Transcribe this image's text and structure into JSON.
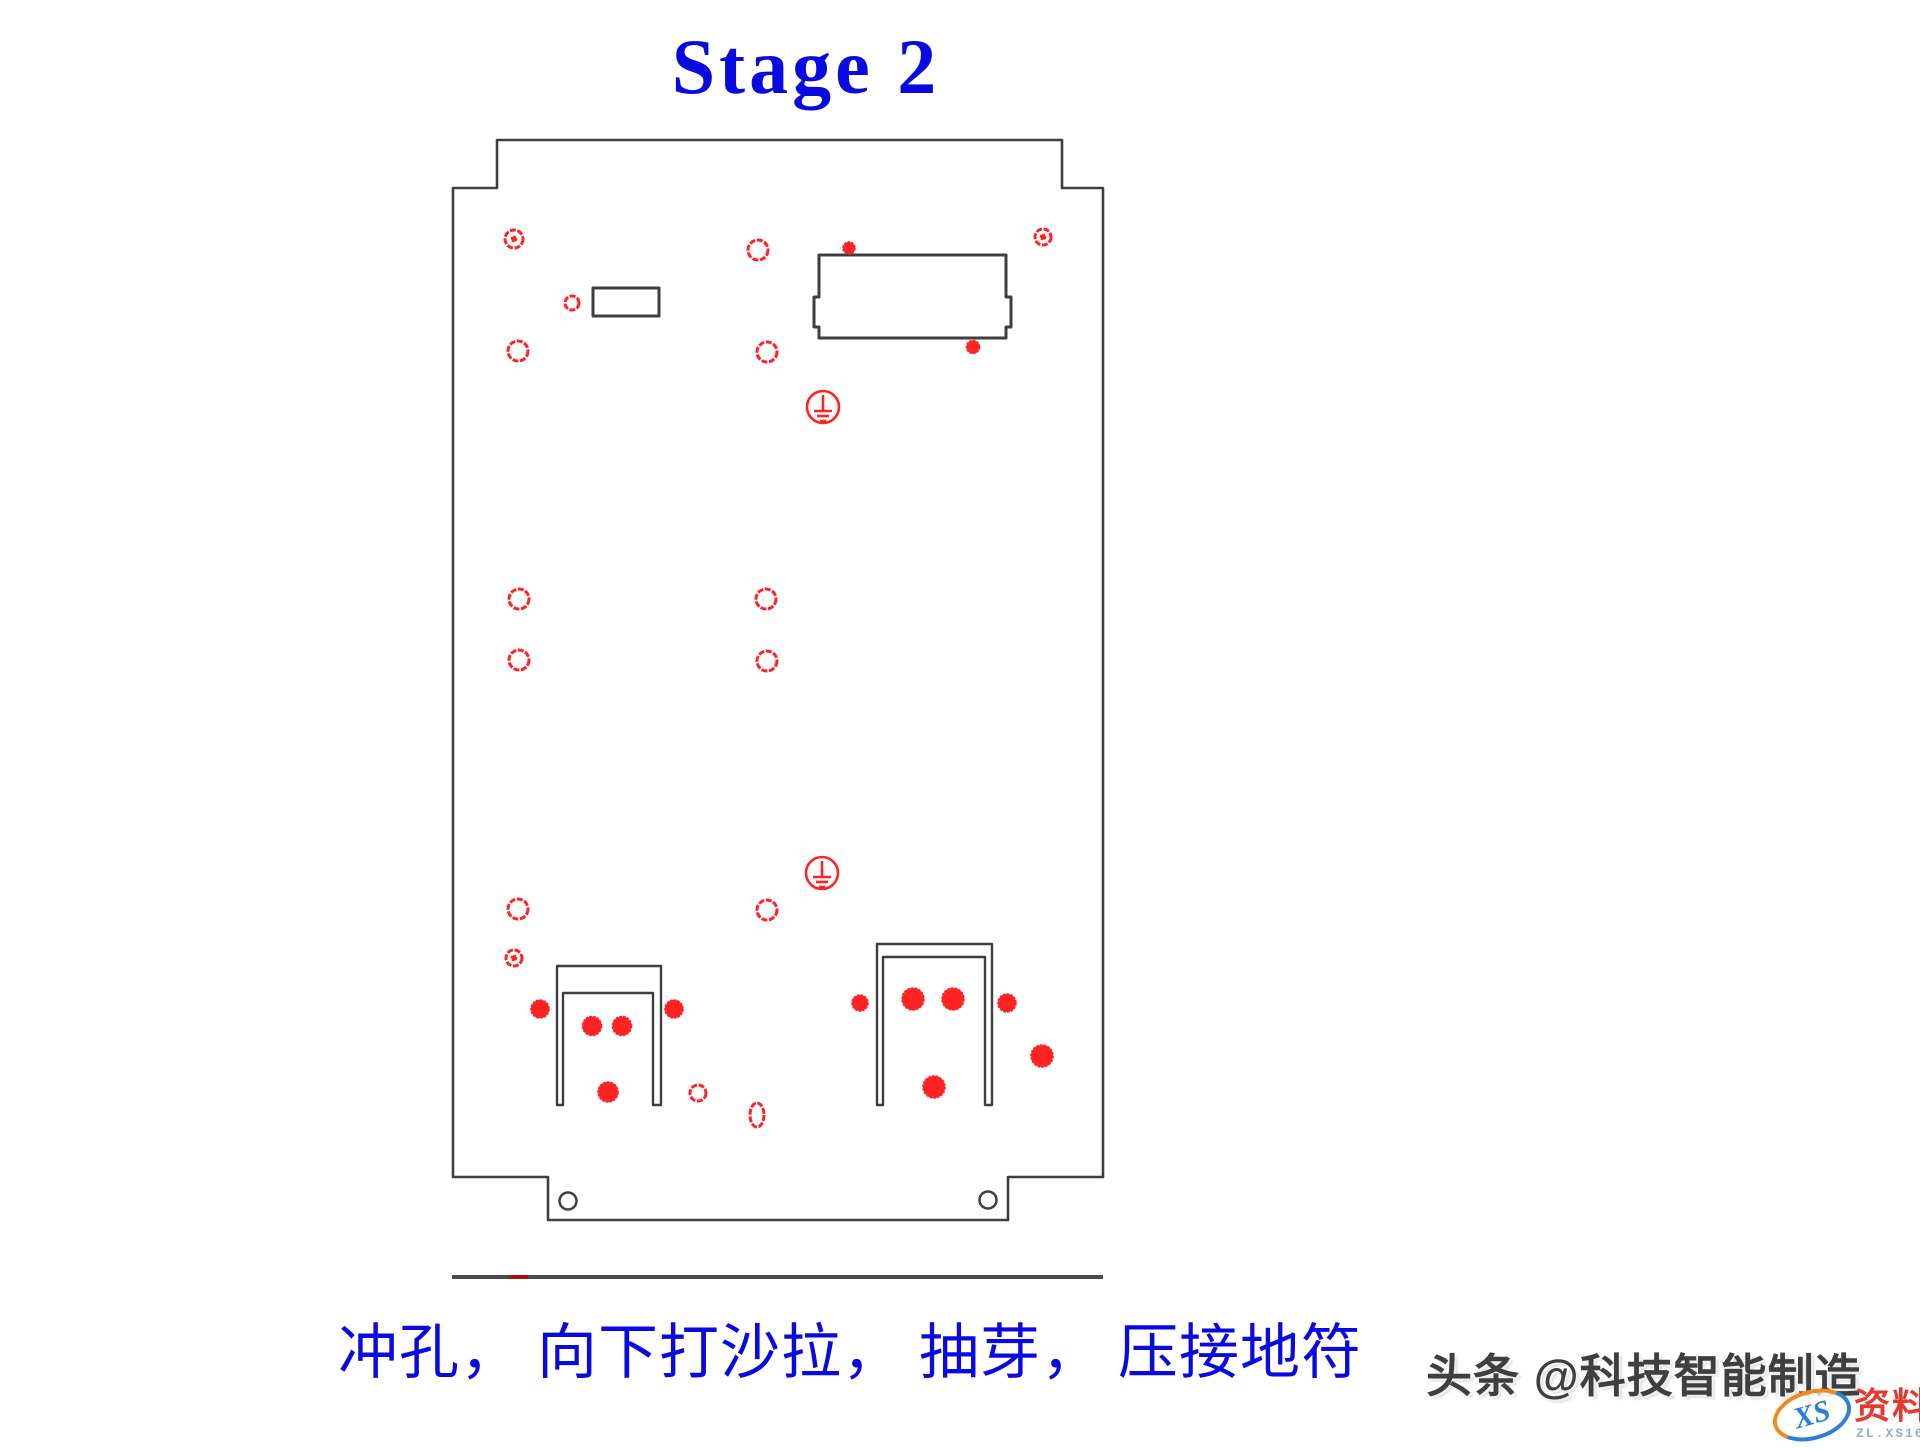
{
  "title": {
    "text": "Stage 2"
  },
  "caption": {
    "text": "冲孔， 向下打沙拉， 抽芽， 压接地符"
  },
  "watermark": {
    "text": "头条 @科技智能制造"
  },
  "logo": {
    "xs": "XS",
    "name": "资料网",
    "url": "ZL.XS1616.COM"
  },
  "colors": {
    "blue": "#0a0ae0",
    "red": "#ff2323",
    "line": "#3f3f3f",
    "baseline_gray": "#4a4a4a",
    "baseline_red": "#a31212",
    "watermark": "#3f3f3f",
    "logo_red": "#e23a2e",
    "logo_blue": "#2f7fd9",
    "logo_orange": "#f08a1c",
    "logo_url": "#93add0"
  },
  "drawing": {
    "outline": "M497,140 L1062,140 L1062,188 L1103,188 L1103,1177 L1008,1177 L1008,1220 L548,1220 L548,1177 L453,1177 L453,188 L497,188 Z",
    "cutouts": [
      "M593,288 L659,288 L659,316 L593,316 Z",
      "M819,255 L1006,255 L1006,297 L1011,297 L1011,327 L1006,327 L1006,338 L819,338 L819,327 L814,327 L814,297 L819,297 Z"
    ],
    "brackets": [
      "M557,1105 L557,966 L661,966 L661,1105 L653,1105 L653,993 L563,993 L563,1105 Z",
      "M877,1105 L877,944 L992,944 L992,1105 L985,1105 L985,957 L883,957 L883,1105 Z"
    ],
    "holes_outline": [
      [
        514,
        239,
        9
      ],
      [
        758,
        250,
        10
      ],
      [
        1043,
        237,
        8
      ],
      [
        572,
        303,
        7
      ],
      [
        518,
        351,
        10
      ],
      [
        767,
        352,
        10
      ],
      [
        519,
        599,
        10
      ],
      [
        766,
        599,
        10
      ],
      [
        519,
        660,
        10
      ],
      [
        767,
        661,
        10
      ],
      [
        518,
        909,
        10
      ],
      [
        767,
        910,
        10
      ],
      [
        514,
        958,
        8
      ],
      [
        698,
        1093,
        8
      ]
    ],
    "center_dots": [
      [
        514,
        239
      ],
      [
        1043,
        237
      ],
      [
        514,
        958
      ]
    ],
    "holes_filled": [
      [
        849,
        248,
        6
      ],
      [
        973,
        347,
        6.5
      ],
      [
        540,
        1009,
        9
      ],
      [
        592,
        1026,
        9.5
      ],
      [
        622,
        1026,
        9.5
      ],
      [
        674,
        1009,
        9
      ],
      [
        608,
        1092,
        10
      ],
      [
        860,
        1003,
        8
      ],
      [
        913,
        999,
        11
      ],
      [
        953,
        999,
        11
      ],
      [
        1007,
        1003,
        9
      ],
      [
        1042,
        1056,
        11
      ],
      [
        934,
        1087,
        11
      ]
    ],
    "ovals": [
      [
        757,
        1115,
        7,
        12
      ]
    ],
    "grounds": [
      [
        823,
        407,
        16
      ],
      [
        822,
        873,
        16
      ]
    ],
    "corner_holes": [
      [
        568,
        1201,
        8.5
      ],
      [
        988,
        1200,
        8.5
      ]
    ],
    "baseline": {
      "y": 1275,
      "h": 4,
      "x1": 452,
      "x2": 1103,
      "red_x1": 509,
      "red_x2": 528
    }
  }
}
